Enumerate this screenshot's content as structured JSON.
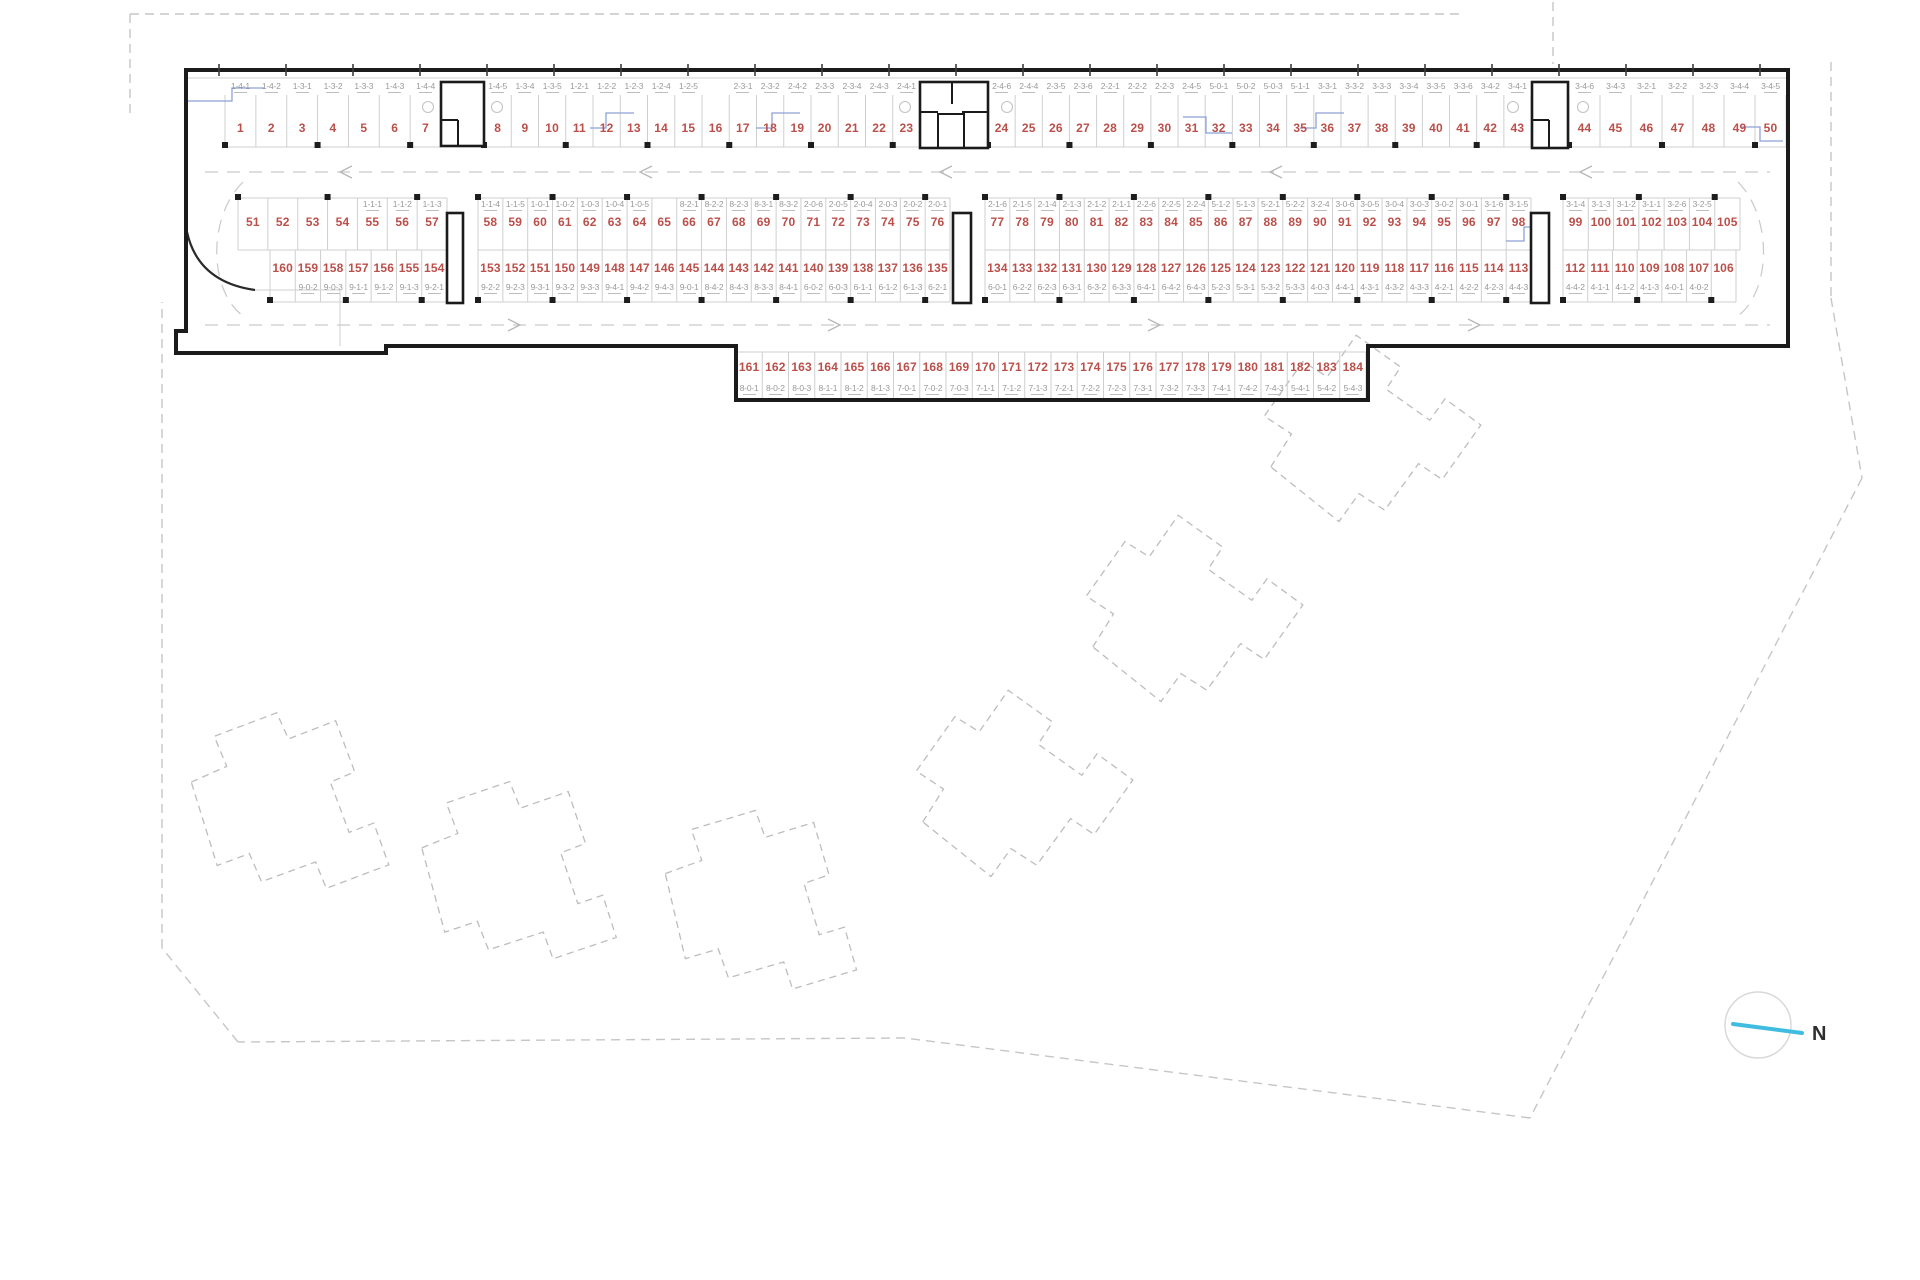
{
  "compass": {
    "label": "N"
  },
  "colors": {
    "space_number": "#bb4f4a",
    "space_code": "#999999",
    "building_outline": "#1b1b1b",
    "dashed_boundary": "#c6c6c6",
    "accent_blue": "#8ea0d8",
    "compass_needle": "#3fbcdf"
  },
  "parking": {
    "rows": [
      {
        "name": "row-1",
        "groups": [
          [
            [
              "1",
              "1-4-1"
            ],
            [
              "2",
              "1-4-2"
            ],
            [
              "3",
              "1-3-1"
            ],
            [
              "4",
              "1-3-2"
            ],
            [
              "5",
              "1-3-3"
            ],
            [
              "6",
              "1-4-3"
            ],
            [
              "7",
              "1-4-4"
            ]
          ],
          [
            [
              "8",
              "1-4-5"
            ],
            [
              "9",
              "1-3-4"
            ],
            [
              "10",
              "1-3-5"
            ],
            [
              "11",
              "1-2-1"
            ],
            [
              "12",
              "1-2-2"
            ],
            [
              "13",
              "1-2-3"
            ],
            [
              "14",
              "1-2-4"
            ],
            [
              "15",
              "1-2-5"
            ],
            [
              "16",
              ""
            ],
            [
              "17",
              "2-3-1"
            ],
            [
              "18",
              "2-3-2"
            ],
            [
              "19",
              "2-4-2"
            ],
            [
              "20",
              "2-3-3"
            ],
            [
              "21",
              "2-3-4"
            ],
            [
              "22",
              "2-4-3"
            ],
            [
              "23",
              "2-4-1"
            ]
          ],
          [
            [
              "24",
              "2-4-6"
            ],
            [
              "25",
              "2-4-4"
            ],
            [
              "26",
              "2-3-5"
            ],
            [
              "27",
              "2-3-6"
            ],
            [
              "28",
              "2-2-1"
            ],
            [
              "29",
              "2-2-2"
            ],
            [
              "30",
              "2-2-3"
            ],
            [
              "31",
              "2-4-5"
            ],
            [
              "32",
              "5-0-1"
            ],
            [
              "33",
              "5-0-2"
            ],
            [
              "34",
              "5-0-3"
            ],
            [
              "35",
              "5-1-1"
            ],
            [
              "36",
              "3-3-1"
            ],
            [
              "37",
              "3-3-2"
            ],
            [
              "38",
              "3-3-3"
            ],
            [
              "39",
              "3-3-4"
            ],
            [
              "40",
              "3-3-5"
            ],
            [
              "41",
              "3-3-6"
            ],
            [
              "42",
              "3-4-2"
            ],
            [
              "43",
              "3-4-1"
            ]
          ],
          [
            [
              "44",
              "3-4-6"
            ],
            [
              "45",
              "3-4-3"
            ],
            [
              "46",
              "3-2-1"
            ],
            [
              "47",
              "3-2-2"
            ],
            [
              "48",
              "3-2-3"
            ],
            [
              "49",
              "3-4-4"
            ],
            [
              "50",
              "3-4-5"
            ]
          ]
        ]
      },
      {
        "name": "row-2",
        "groups": [
          [
            [
              "51",
              ""
            ],
            [
              "52",
              ""
            ],
            [
              "53",
              ""
            ],
            [
              "54",
              ""
            ],
            [
              "55",
              "1-1-1"
            ],
            [
              "56",
              "1-1-2"
            ],
            [
              "57",
              "1-1-3"
            ]
          ],
          [
            [
              "58",
              "1-1-4"
            ],
            [
              "59",
              "1-1-5"
            ],
            [
              "60",
              "1-0-1"
            ],
            [
              "61",
              "1-0-2"
            ],
            [
              "62",
              "1-0-3"
            ],
            [
              "63",
              "1-0-4"
            ],
            [
              "64",
              "1-0-5"
            ],
            [
              "65",
              ""
            ],
            [
              "66",
              "8-2-1"
            ],
            [
              "67",
              "8-2-2"
            ],
            [
              "68",
              "8-2-3"
            ],
            [
              "69",
              "8-3-1"
            ],
            [
              "70",
              "8-3-2"
            ],
            [
              "71",
              "2-0-6"
            ],
            [
              "72",
              "2-0-5"
            ],
            [
              "73",
              "2-0-4"
            ],
            [
              "74",
              "2-0-3"
            ],
            [
              "75",
              "2-0-2"
            ],
            [
              "76",
              "2-0-1"
            ]
          ],
          [
            [
              "77",
              "2-1-6"
            ],
            [
              "78",
              "2-1-5"
            ],
            [
              "79",
              "2-1-4"
            ],
            [
              "80",
              "2-1-3"
            ],
            [
              "81",
              "2-1-2"
            ],
            [
              "82",
              "2-1-1"
            ],
            [
              "83",
              "2-2-6"
            ],
            [
              "84",
              "2-2-5"
            ],
            [
              "85",
              "2-2-4"
            ],
            [
              "86",
              "5-1-2"
            ],
            [
              "87",
              "5-1-3"
            ],
            [
              "88",
              "5-2-1"
            ],
            [
              "89",
              "5-2-2"
            ],
            [
              "90",
              "3-2-4"
            ],
            [
              "91",
              "3-0-6"
            ],
            [
              "92",
              "3-0-5"
            ],
            [
              "93",
              "3-0-4"
            ],
            [
              "94",
              "3-0-3"
            ],
            [
              "95",
              "3-0-2"
            ],
            [
              "96",
              "3-0-1"
            ],
            [
              "97",
              "3-1-6"
            ],
            [
              "98",
              "3-1-5"
            ]
          ],
          [
            [
              "99",
              "3-1-4"
            ],
            [
              "100",
              "3-1-3"
            ],
            [
              "101",
              "3-1-2"
            ],
            [
              "102",
              "3-1-1"
            ],
            [
              "103",
              "3-2-6"
            ],
            [
              "104",
              "3-2-5"
            ],
            [
              "105",
              ""
            ]
          ]
        ]
      },
      {
        "name": "row-3",
        "groups": [
          [
            [
              "160",
              ""
            ],
            [
              "159",
              "9-0-2"
            ],
            [
              "158",
              "9-0-3"
            ],
            [
              "157",
              "9-1-1"
            ],
            [
              "156",
              "9-1-2"
            ],
            [
              "155",
              "9-1-3"
            ],
            [
              "154",
              "9-2-1"
            ]
          ],
          [
            [
              "153",
              "9-2-2"
            ],
            [
              "152",
              "9-2-3"
            ],
            [
              "151",
              "9-3-1"
            ],
            [
              "150",
              "9-3-2"
            ],
            [
              "149",
              "9-3-3"
            ],
            [
              "148",
              "9-4-1"
            ],
            [
              "147",
              "9-4-2"
            ],
            [
              "146",
              "9-4-3"
            ],
            [
              "145",
              "9-0-1"
            ],
            [
              "144",
              "8-4-2"
            ],
            [
              "143",
              "8-4-3"
            ],
            [
              "142",
              "8-3-3"
            ],
            [
              "141",
              "8-4-1"
            ],
            [
              "140",
              "6-0-2"
            ],
            [
              "139",
              "6-0-3"
            ],
            [
              "138",
              "6-1-1"
            ],
            [
              "137",
              "6-1-2"
            ],
            [
              "136",
              "6-1-3"
            ],
            [
              "135",
              "6-2-1"
            ]
          ],
          [
            [
              "134",
              "6-0-1"
            ],
            [
              "133",
              "6-2-2"
            ],
            [
              "132",
              "6-2-3"
            ],
            [
              "131",
              "6-3-1"
            ],
            [
              "130",
              "6-3-2"
            ],
            [
              "129",
              "6-3-3"
            ],
            [
              "128",
              "6-4-1"
            ],
            [
              "127",
              "6-4-2"
            ],
            [
              "126",
              "6-4-3"
            ],
            [
              "125",
              "5-2-3"
            ],
            [
              "124",
              "5-3-1"
            ],
            [
              "123",
              "5-3-2"
            ],
            [
              "122",
              "5-3-3"
            ],
            [
              "121",
              "4-0-3"
            ],
            [
              "120",
              "4-4-1"
            ],
            [
              "119",
              "4-3-1"
            ],
            [
              "118",
              "4-3-2"
            ],
            [
              "117",
              "4-3-3"
            ],
            [
              "116",
              "4-2-1"
            ],
            [
              "115",
              "4-2-2"
            ],
            [
              "114",
              "4-2-3"
            ],
            [
              "113",
              "4-4-3"
            ]
          ],
          [
            [
              "112",
              "4-4-2"
            ],
            [
              "111",
              "4-1-1"
            ],
            [
              "110",
              "4-1-2"
            ],
            [
              "109",
              "4-1-3"
            ],
            [
              "108",
              "4-0-1"
            ],
            [
              "107",
              "4-0-2"
            ],
            [
              "106",
              ""
            ]
          ]
        ]
      },
      {
        "name": "row-4",
        "groups": [
          [
            [
              "161",
              "8-0-1"
            ],
            [
              "162",
              "8-0-2"
            ],
            [
              "163",
              "8-0-3"
            ],
            [
              "164",
              "8-1-1"
            ],
            [
              "165",
              "8-1-2"
            ],
            [
              "166",
              "8-1-3"
            ],
            [
              "167",
              "7-0-1"
            ],
            [
              "168",
              "7-0-2"
            ],
            [
              "169",
              "7-0-3"
            ],
            [
              "170",
              "7-1-1"
            ],
            [
              "171",
              "7-1-2"
            ],
            [
              "172",
              "7-1-3"
            ],
            [
              "173",
              "7-2-1"
            ],
            [
              "174",
              "7-2-2"
            ],
            [
              "175",
              "7-2-3"
            ],
            [
              "176",
              "7-3-1"
            ],
            [
              "177",
              "7-3-2"
            ],
            [
              "178",
              "7-3-3"
            ],
            [
              "179",
              "7-4-1"
            ],
            [
              "180",
              "7-4-2"
            ],
            [
              "181",
              "7-4-3"
            ],
            [
              "182",
              "5-4-1"
            ],
            [
              "183",
              "5-4-2"
            ],
            [
              "184",
              "5-4-3"
            ]
          ]
        ]
      }
    ]
  }
}
